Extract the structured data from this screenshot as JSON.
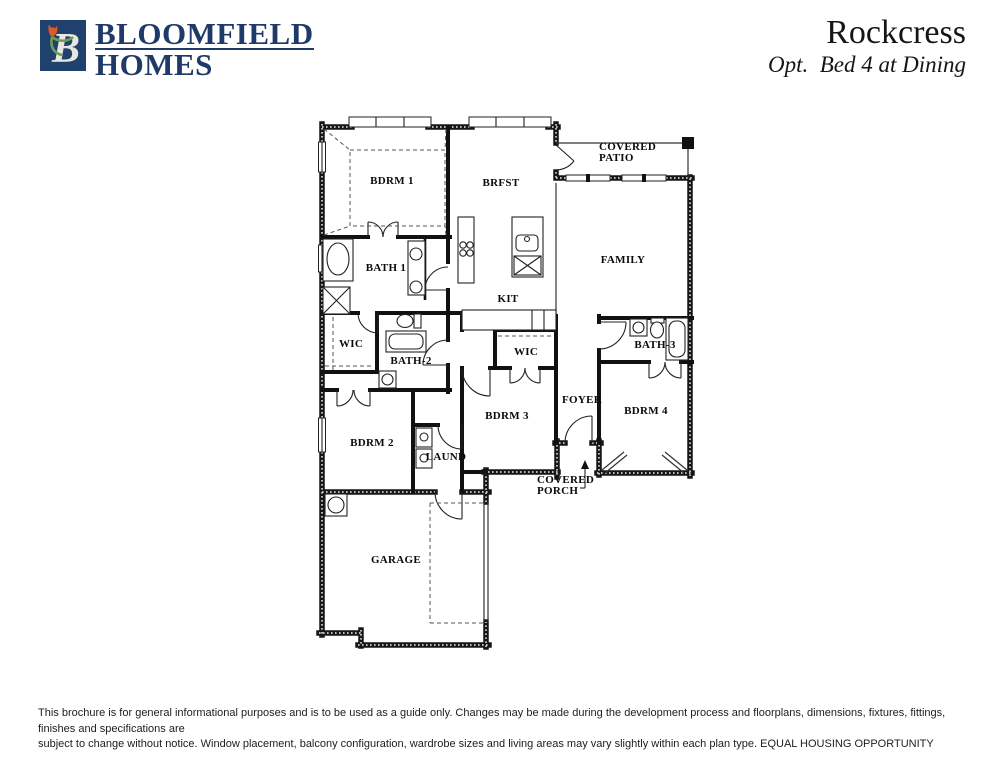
{
  "header": {
    "brand_line1": "BLOOMFIELD",
    "brand_line2": "HOMES",
    "logo_letter": "B",
    "plan_name": "Rockcress",
    "plan_option": "Opt.  Bed 4 at Dining"
  },
  "floorplan": {
    "rooms": {
      "bdrm1": "BDRM 1",
      "brfst": "BRFST",
      "covered_patio": "COVERED\nPATIO",
      "family": "FAMILY",
      "bath1": "BATH 1",
      "kit": "KIT",
      "wic_left": "WIC",
      "bath2": "BATH-2",
      "wic_mid": "WIC",
      "bath3": "BATH-3",
      "foyer": "FOYER",
      "bdrm3": "BDRM 3",
      "bdrm4": "BDRM 4",
      "bdrm2": "BDRM 2",
      "laund": "LAUND",
      "covered_porch": "COVERED\nPORCH",
      "garage": "GARAGE"
    }
  },
  "footer": {
    "disclaimer_line1": "This brochure is for general informational purposes and is to be used as a guide only. Changes may be made during the development process and floorplans, dimensions, fixtures, fittings, finishes and specifications are",
    "disclaimer_line2": "subject to change without notice. Window placement, balcony configuration, wardrobe sizes and living areas may vary slightly within each plan type.  EQUAL HOUSING OPPORTUNITY"
  },
  "colors": {
    "brand_navy": "#1f3a68",
    "tulip_orange": "#e05a28",
    "leaf_green": "#6aa04e",
    "wall_black": "#111111"
  }
}
